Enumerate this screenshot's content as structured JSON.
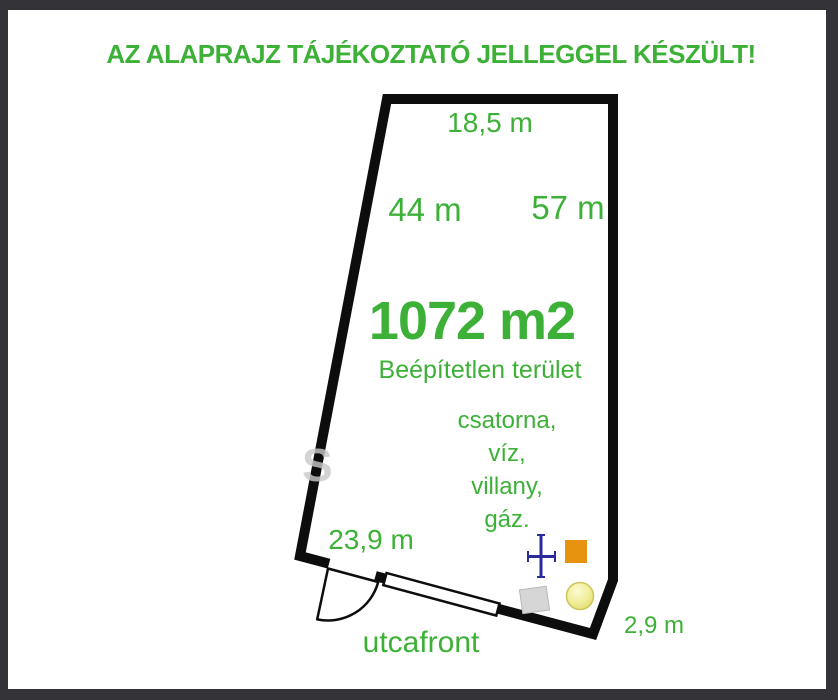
{
  "title": "AZ ALAPRAJZ TÁJÉKOZTATÓ JELLEGGEL KÉSZÜLT!",
  "plot": {
    "area": "1072 m2",
    "land_status": "Beépítetlen terület",
    "utilities": [
      "csatorna,",
      "víz,",
      "villany,",
      "gáz."
    ],
    "dimensions": {
      "top": "18,5 m",
      "left_side": "44 m",
      "right_side": "57 m",
      "street_front": "23,9 m",
      "chamfer": "2,9 m"
    },
    "street_label": "utcafront",
    "watermark": "S"
  },
  "colors": {
    "accent_green": "#3db137",
    "wall": "#0d0d0d",
    "frame": "#333338",
    "marker_blue": "#2b2b9e",
    "marker_orange": "#e8930f",
    "marker_yellow": "#f1ee9c",
    "marker_yellow_border": "#cdc75a",
    "marker_gray": "#d6d6d6"
  }
}
